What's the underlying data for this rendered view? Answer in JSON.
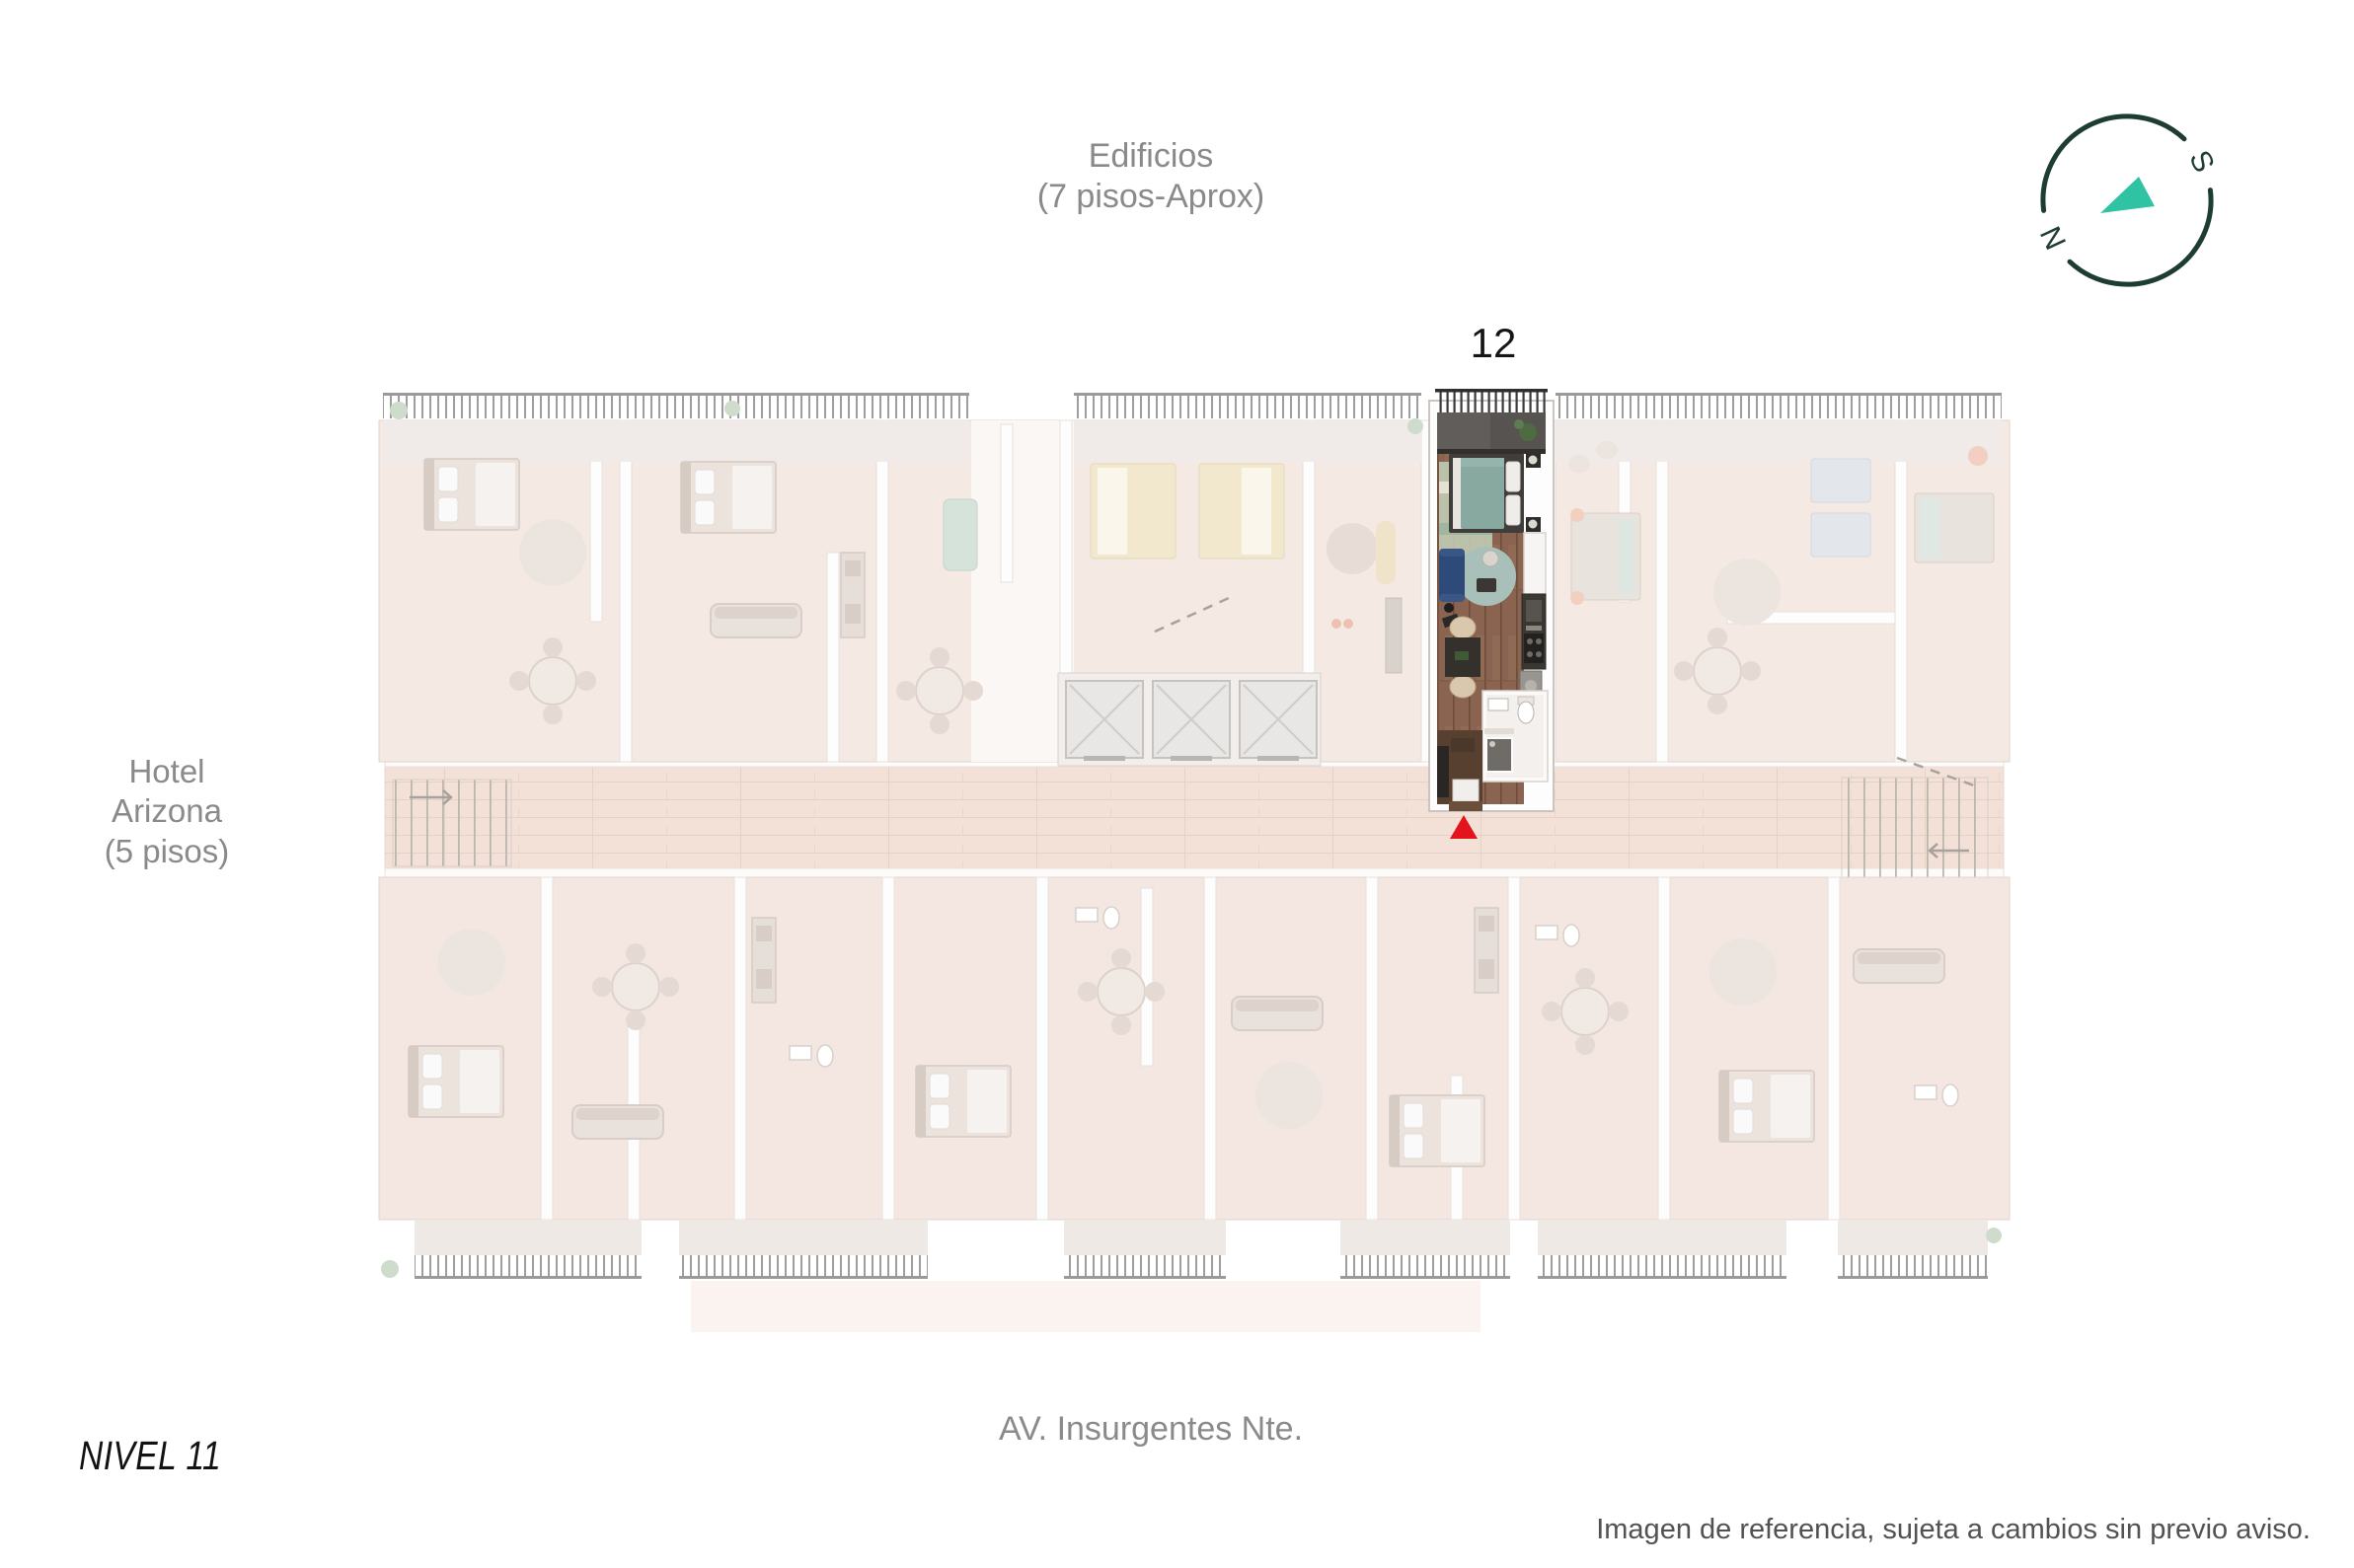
{
  "labels": {
    "building_top": {
      "line1": "Edificios",
      "line2": "(7 pisos-Aprox)"
    },
    "hotel": {
      "line1": "Hotel",
      "line2": "Arizona",
      "line3": "(5 pisos)"
    },
    "unit_number": "12",
    "level": "NIVEL 11",
    "street": "AV. Insurgentes Nte.",
    "disclaimer": "Imagen de referencia, sujeta a cambios sin previo aviso."
  },
  "compass": {
    "north": "N",
    "south": "S"
  },
  "colors": {
    "label_gray": "#8a8a8a",
    "text_dark": "#151515",
    "disclaimer_gray": "#525252",
    "marker_red": "#e3141b",
    "compass_ring": "#1d3c34",
    "compass_needle": "#2fc3a4",
    "unit_wood": "#8a6450",
    "unit_bed_teal": "#87a9a0",
    "unit_sofa_blue": "#2d4a78",
    "faded_room": "#f5e9e3"
  }
}
